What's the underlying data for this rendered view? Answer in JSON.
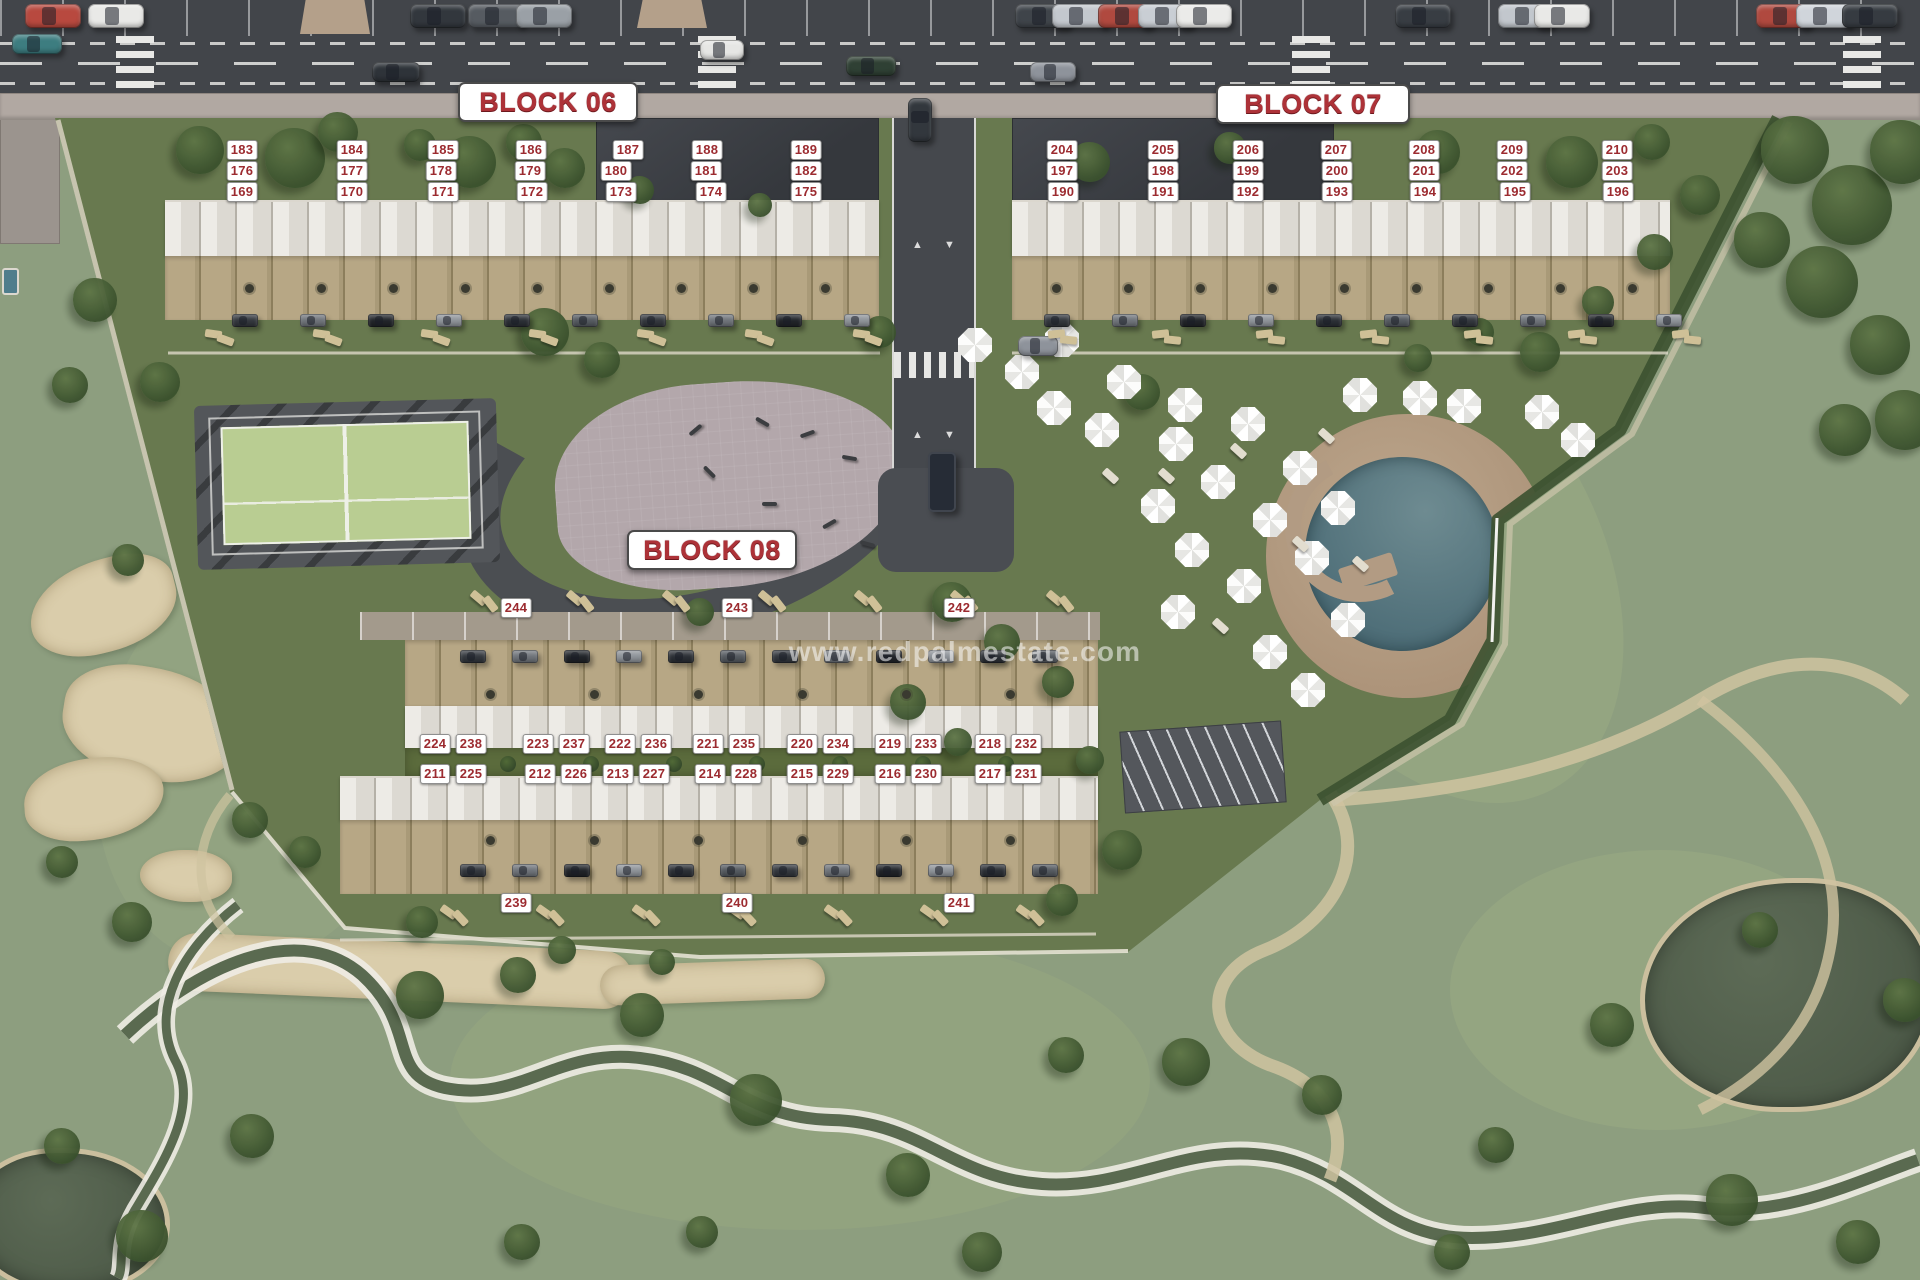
{
  "watermark": "www.redpalmestate.com",
  "colors": {
    "badge_bg": "#ffffff",
    "badge_text": "#9c2b30",
    "title_text": "#ad3238",
    "asphalt": "#42454a",
    "sidewalk": "#b1a8a2",
    "dev_green": "#68794f",
    "golf_green": "#8d9e7f",
    "courtyard_green": "#5b6b3c",
    "pool_water": "#4e6e78",
    "pool_deck": "#ac9379",
    "court_green": "#b9cd92",
    "plaza_pink": "#b3a7ab",
    "sand": "#dacdab",
    "water_dark": "#4d5a48"
  },
  "blocks": [
    {
      "name": "block-06",
      "title": "BLOCK 06",
      "title_box": {
        "x": 458,
        "y": 82,
        "w": 180,
        "h": 40
      },
      "units": [
        {
          "n": "183",
          "x": 242,
          "y": 150
        },
        {
          "n": "184",
          "x": 352,
          "y": 150
        },
        {
          "n": "185",
          "x": 443,
          "y": 150
        },
        {
          "n": "186",
          "x": 531,
          "y": 150
        },
        {
          "n": "187",
          "x": 628,
          "y": 150
        },
        {
          "n": "188",
          "x": 707,
          "y": 150
        },
        {
          "n": "189",
          "x": 806,
          "y": 150
        },
        {
          "n": "176",
          "x": 242,
          "y": 171
        },
        {
          "n": "177",
          "x": 352,
          "y": 171
        },
        {
          "n": "178",
          "x": 441,
          "y": 171
        },
        {
          "n": "179",
          "x": 530,
          "y": 171
        },
        {
          "n": "180",
          "x": 616,
          "y": 171
        },
        {
          "n": "181",
          "x": 706,
          "y": 171
        },
        {
          "n": "182",
          "x": 806,
          "y": 171
        },
        {
          "n": "169",
          "x": 242,
          "y": 192
        },
        {
          "n": "170",
          "x": 352,
          "y": 192
        },
        {
          "n": "171",
          "x": 443,
          "y": 192
        },
        {
          "n": "172",
          "x": 532,
          "y": 192
        },
        {
          "n": "173",
          "x": 621,
          "y": 192
        },
        {
          "n": "174",
          "x": 711,
          "y": 192
        },
        {
          "n": "175",
          "x": 806,
          "y": 192
        }
      ]
    },
    {
      "name": "block-07",
      "title": "BLOCK 07",
      "title_box": {
        "x": 1216,
        "y": 84,
        "w": 194,
        "h": 40
      },
      "units": [
        {
          "n": "204",
          "x": 1062,
          "y": 150
        },
        {
          "n": "205",
          "x": 1163,
          "y": 150
        },
        {
          "n": "206",
          "x": 1248,
          "y": 150
        },
        {
          "n": "207",
          "x": 1336,
          "y": 150
        },
        {
          "n": "208",
          "x": 1424,
          "y": 150
        },
        {
          "n": "209",
          "x": 1512,
          "y": 150
        },
        {
          "n": "210",
          "x": 1617,
          "y": 150
        },
        {
          "n": "197",
          "x": 1062,
          "y": 171
        },
        {
          "n": "198",
          "x": 1163,
          "y": 171
        },
        {
          "n": "199",
          "x": 1248,
          "y": 171
        },
        {
          "n": "200",
          "x": 1337,
          "y": 171
        },
        {
          "n": "201",
          "x": 1424,
          "y": 171
        },
        {
          "n": "202",
          "x": 1512,
          "y": 171
        },
        {
          "n": "203",
          "x": 1617,
          "y": 171
        },
        {
          "n": "190",
          "x": 1063,
          "y": 192
        },
        {
          "n": "191",
          "x": 1163,
          "y": 192
        },
        {
          "n": "192",
          "x": 1248,
          "y": 192
        },
        {
          "n": "193",
          "x": 1337,
          "y": 192
        },
        {
          "n": "194",
          "x": 1425,
          "y": 192
        },
        {
          "n": "195",
          "x": 1515,
          "y": 192
        },
        {
          "n": "196",
          "x": 1618,
          "y": 192
        }
      ]
    },
    {
      "name": "block-08",
      "title": "BLOCK 08",
      "title_box": {
        "x": 627,
        "y": 530,
        "w": 170,
        "h": 40
      },
      "units": [
        {
          "n": "244",
          "x": 516,
          "y": 608
        },
        {
          "n": "243",
          "x": 737,
          "y": 608
        },
        {
          "n": "242",
          "x": 959,
          "y": 608
        },
        {
          "n": "224",
          "x": 435,
          "y": 744
        },
        {
          "n": "238",
          "x": 471,
          "y": 744
        },
        {
          "n": "223",
          "x": 538,
          "y": 744
        },
        {
          "n": "237",
          "x": 574,
          "y": 744
        },
        {
          "n": "222",
          "x": 620,
          "y": 744
        },
        {
          "n": "236",
          "x": 656,
          "y": 744
        },
        {
          "n": "221",
          "x": 708,
          "y": 744
        },
        {
          "n": "235",
          "x": 744,
          "y": 744
        },
        {
          "n": "220",
          "x": 802,
          "y": 744
        },
        {
          "n": "234",
          "x": 838,
          "y": 744
        },
        {
          "n": "219",
          "x": 890,
          "y": 744
        },
        {
          "n": "233",
          "x": 926,
          "y": 744
        },
        {
          "n": "218",
          "x": 990,
          "y": 744
        },
        {
          "n": "232",
          "x": 1026,
          "y": 744
        },
        {
          "n": "211",
          "x": 435,
          "y": 774
        },
        {
          "n": "225",
          "x": 471,
          "y": 774
        },
        {
          "n": "212",
          "x": 540,
          "y": 774
        },
        {
          "n": "226",
          "x": 576,
          "y": 774
        },
        {
          "n": "213",
          "x": 618,
          "y": 774
        },
        {
          "n": "227",
          "x": 654,
          "y": 774
        },
        {
          "n": "214",
          "x": 710,
          "y": 774
        },
        {
          "n": "228",
          "x": 746,
          "y": 774
        },
        {
          "n": "215",
          "x": 802,
          "y": 774
        },
        {
          "n": "229",
          "x": 838,
          "y": 774
        },
        {
          "n": "216",
          "x": 890,
          "y": 774
        },
        {
          "n": "230",
          "x": 926,
          "y": 774
        },
        {
          "n": "217",
          "x": 990,
          "y": 774
        },
        {
          "n": "231",
          "x": 1026,
          "y": 774
        },
        {
          "n": "239",
          "x": 516,
          "y": 903
        },
        {
          "n": "240",
          "x": 737,
          "y": 903
        },
        {
          "n": "241",
          "x": 959,
          "y": 903
        }
      ]
    }
  ]
}
